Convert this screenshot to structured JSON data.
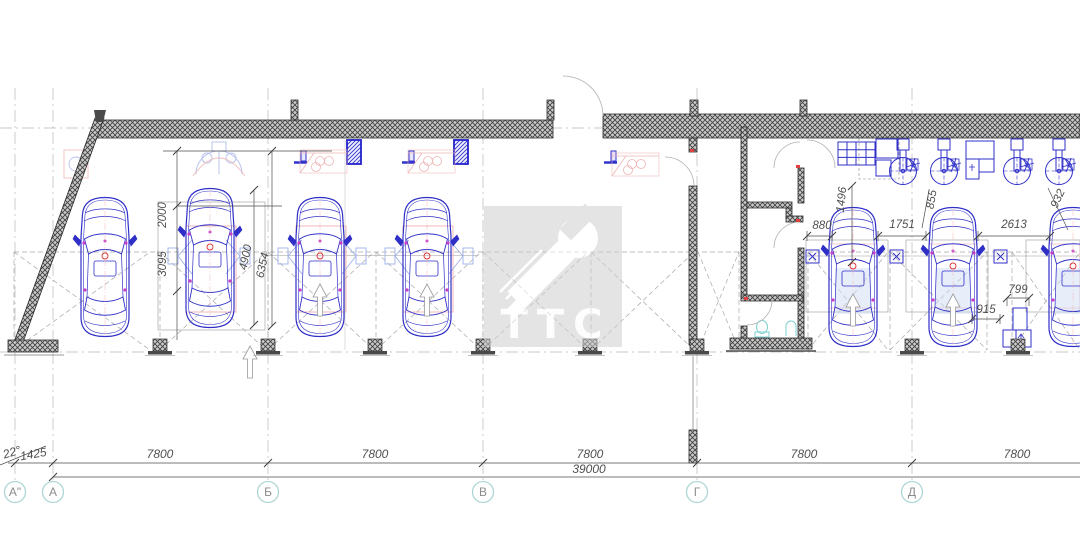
{
  "watermark": {
    "label": "ТТС"
  },
  "axes": [
    {
      "label": "А\""
    },
    {
      "label": "А"
    },
    {
      "label": "Б"
    },
    {
      "label": "В"
    },
    {
      "label": "Г"
    },
    {
      "label": "Д"
    }
  ],
  "dims": {
    "bottom": {
      "angle": "22°",
      "offset": "1425",
      "bays": [
        "7800",
        "7800",
        "7800",
        "7800",
        "7800"
      ],
      "total": "39000"
    },
    "left": [
      "2000",
      "3095",
      "4900",
      "6354"
    ],
    "right": [
      "1496",
      "855",
      "932",
      "880",
      "1751",
      "2613",
      "915",
      "799"
    ]
  },
  "colors": {
    "car_blue": "#2f2fc8",
    "hatch_dark": "#3f3f3f",
    "dim_text": "#4f4f4f",
    "axis_ring": "#aed6d6",
    "lift_pink": "#f0b0b0",
    "marker_magenta": "#c83cc8",
    "fixture_cyan": "#7ecfcf"
  }
}
